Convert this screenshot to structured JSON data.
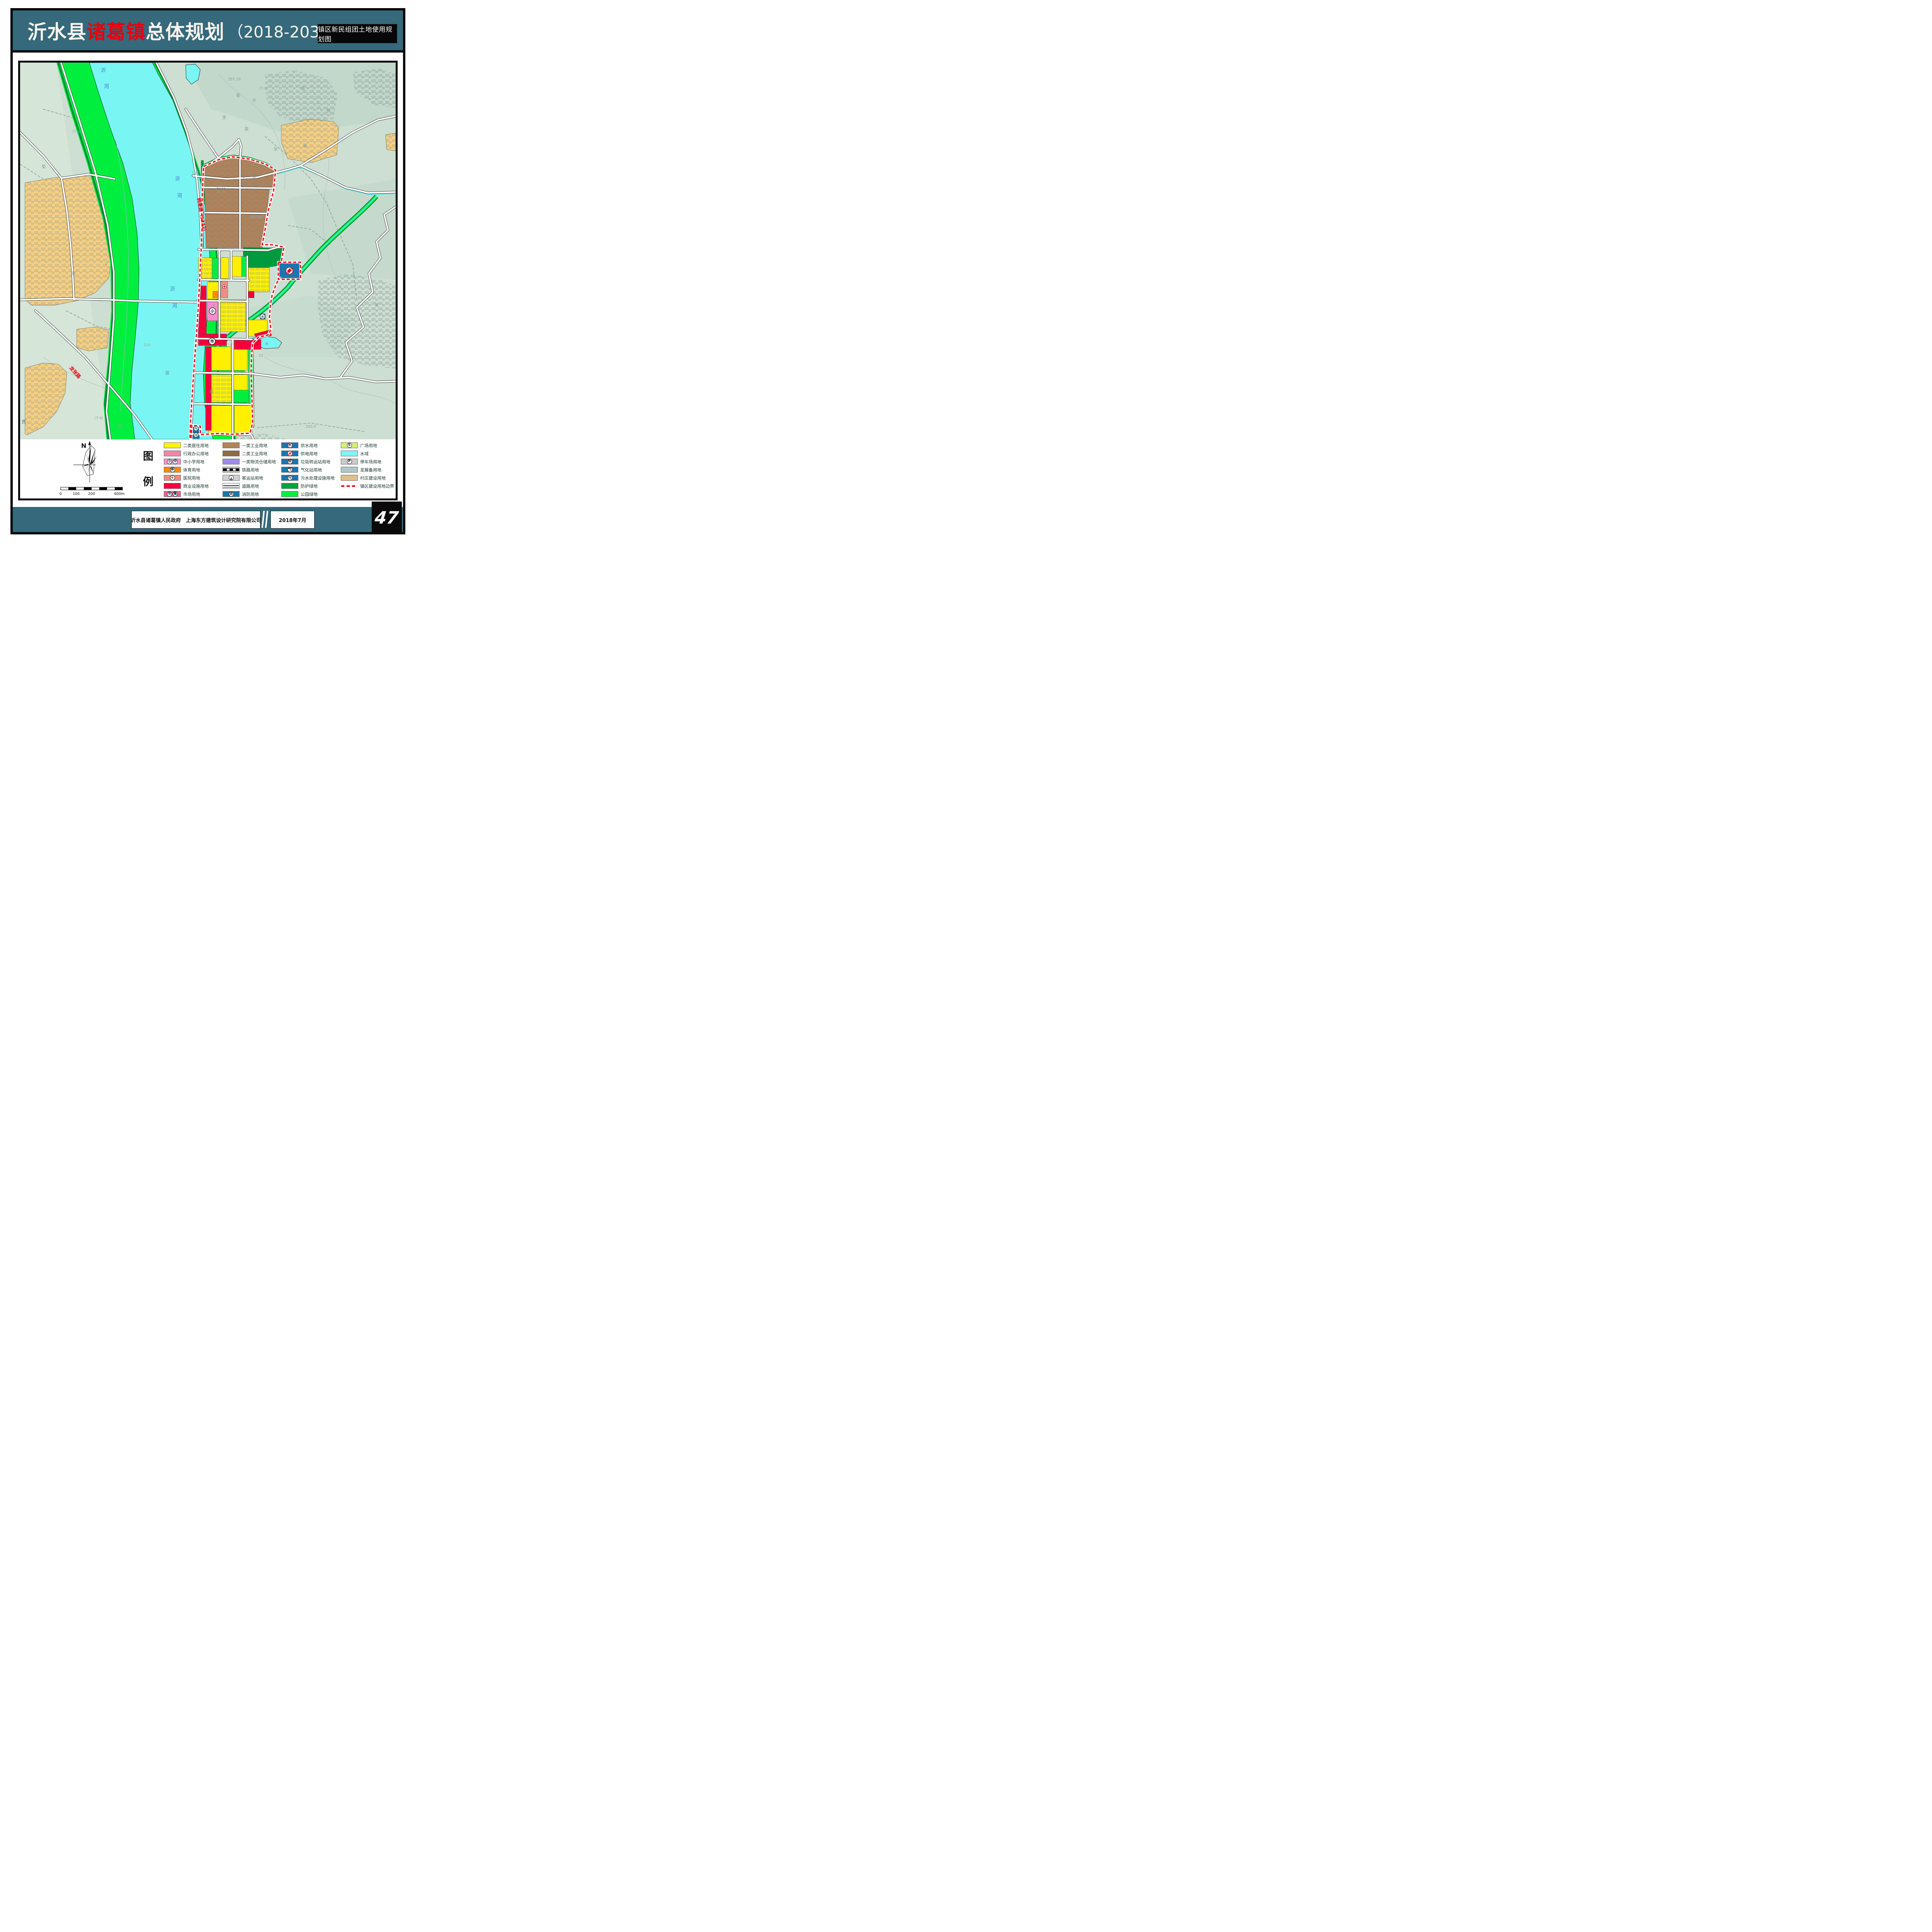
{
  "header": {
    "title_part1": "沂水县",
    "title_part2": "诸葛镇",
    "title_part3": "总体规划",
    "title_part4": "（2018-2035 年）",
    "corner_label": "镇区新民组团土地使用规划图",
    "accent_red": "#e8000f",
    "band_teal": "#35697b"
  },
  "footer": {
    "credit": "沂水县诸葛镇人民政府　上海东方建筑设计研究院有限公司",
    "date": "2018年7月",
    "page_number": "47"
  },
  "legend": {
    "title_char1": "图",
    "title_char2": "例",
    "compass_label": "N",
    "scale_ticks": [
      "0",
      "100",
      "200",
      "400m"
    ],
    "columns": [
      [
        {
          "label": "二类居住用地",
          "type": "plain",
          "color": "#FFF500"
        },
        {
          "label": "行政办公用地",
          "type": "plain",
          "color": "#F286A6"
        },
        {
          "label": "中小学用地",
          "type": "badges",
          "color": "#FC8FD2",
          "badges": [
            "小",
            "中"
          ]
        },
        {
          "label": "体育用地",
          "type": "badges",
          "color": "#FF8A00",
          "badges": [
            "体"
          ]
        },
        {
          "label": "医院用地",
          "type": "cross",
          "color": "#F08A80"
        },
        {
          "label": "商业设施用地",
          "type": "plain",
          "color": "#F3003C"
        },
        {
          "label": "市场用地",
          "type": "badges",
          "color": "#F2608F",
          "badges": [
            "市",
            "集"
          ]
        }
      ],
      [
        {
          "label": "一类工业用地",
          "type": "plain",
          "color": "#B2855C"
        },
        {
          "label": "二类工业用地",
          "type": "plain",
          "color": "#8C6C48"
        },
        {
          "label": "一类物流仓储用地",
          "type": "plain",
          "color": "#9E8BEF"
        },
        {
          "label": "铁路用地",
          "type": "rail",
          "color": "#C9C9C9"
        },
        {
          "label": "客运站用地",
          "type": "bus",
          "color": "#D2D2D2"
        },
        {
          "label": "道路用地",
          "type": "road",
          "color": "#FFFFFF"
        },
        {
          "label": "消防用地",
          "type": "badges",
          "color": "#1878AE",
          "badges": [
            "消"
          ]
        }
      ],
      [
        {
          "label": "供水用地",
          "type": "badges",
          "color": "#1878AE",
          "badges": [
            "水"
          ]
        },
        {
          "label": "供电用地",
          "type": "bolt",
          "color": "#1878AE"
        },
        {
          "label": "垃圾转运站用地",
          "type": "badges",
          "color": "#1878AE",
          "badges": [
            "转"
          ]
        },
        {
          "label": "气化站用地",
          "type": "badges",
          "color": "#1878AE",
          "badges": [
            "气"
          ]
        },
        {
          "label": "污水处理设施用地",
          "type": "badges",
          "color": "#1878AE",
          "badges": [
            "污"
          ]
        },
        {
          "label": "防护绿地",
          "type": "plain",
          "color": "#00A33D"
        },
        {
          "label": "公园绿地",
          "type": "plain",
          "color": "#00F23C"
        }
      ],
      [
        {
          "label": "广场用地",
          "type": "badges",
          "color": "#D6EF76",
          "badges": [
            "S"
          ]
        },
        {
          "label": "水域",
          "type": "plain",
          "color": "#7DF7F7"
        },
        {
          "label": "停车场用地",
          "type": "badges",
          "color": "#CCCCCC",
          "badges": [
            "P"
          ]
        },
        {
          "label": "发展备用地",
          "type": "plain",
          "color": "#AFC7C9"
        },
        {
          "label": "村庄建设用地",
          "type": "plain",
          "color": "#DCC18A"
        },
        {
          "label": "镇区建设用地边界",
          "type": "boundary",
          "color": "#F10012"
        }
      ]
    ]
  },
  "map_labels": {
    "riverA1": "沂",
    "riverA2": "河",
    "riverB1": "沂",
    "riverB2": "河",
    "riverC1": "沂",
    "riverC2": "河",
    "road_hanlai": "韩莱路（S332）",
    "road_longzhang": "龙张路",
    "mine": "韩旺铁矿",
    "parcel1": "张沂22",
    "parcel2": "83.35",
    "pu1": "葡",
    "pu2": "葡",
    "pu3": "葡",
    "pu4": "葡",
    "ping1": "苹",
    "ping2": "苹",
    "li": "栗",
    "miao1": "苗",
    "miao2": "苗",
    "zha": "渣",
    "jing": "井",
    "chou": "抽",
    "you": "油",
    "sheng": "牲",
    "xi": "西",
    "n1": "287.29",
    "n2": "110",
    "n3": "52",
    "n4": "200.9",
    "n5": "15",
    "n6": "3",
    "r1": "（7-9）",
    "r2": "（7-9）",
    "r3": "（7-9）",
    "b_xiao": "小",
    "b_shi": "市",
    "b_shui": "水",
    "b_qi": "气",
    "b_wu": "污",
    "b_qiu": "球",
    "well": "水",
    "pond_shui": "水"
  }
}
